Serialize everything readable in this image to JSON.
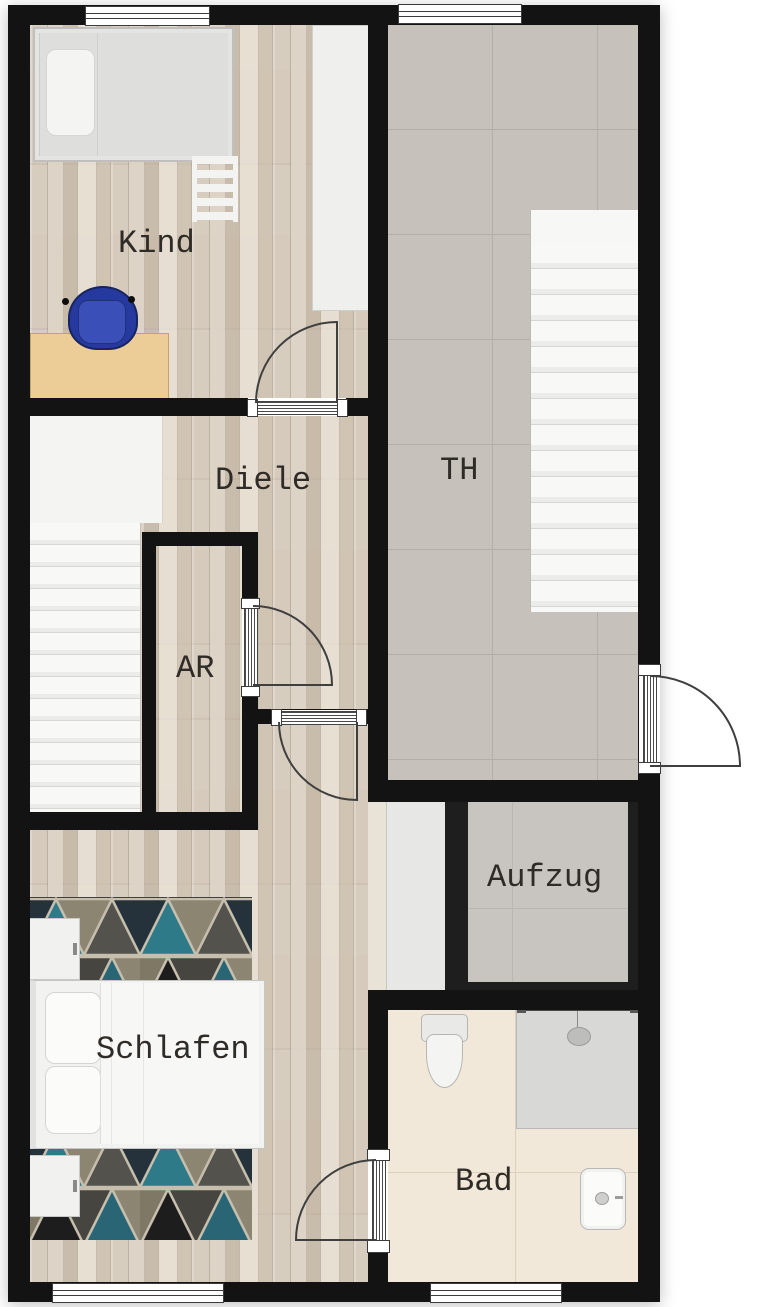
{
  "type": "floor-plan",
  "rooms": [
    {
      "id": "kind",
      "label": "Kind"
    },
    {
      "id": "diele",
      "label": "Diele"
    },
    {
      "id": "ar",
      "label": "AR"
    },
    {
      "id": "th",
      "label": "TH"
    },
    {
      "id": "aufzug",
      "label": "Aufzug"
    },
    {
      "id": "schlafen",
      "label": "Schlafen"
    },
    {
      "id": "bad",
      "label": "Bad"
    }
  ],
  "fixtures": [
    "single-bed",
    "bunk-ladder",
    "wall-shelf",
    "desk",
    "desk-chair",
    "staircase-left",
    "staircase-th",
    "elevator-cab",
    "double-bed",
    "nightstand-top",
    "nightstand-bottom",
    "triangle-rug",
    "wardrobe",
    "shower",
    "toilet",
    "sink"
  ],
  "openings": {
    "windows": 4,
    "door_swings": 5
  },
  "colors": {
    "wall": "#131313",
    "wood_floor": "#d5cabc",
    "tile_floor": "#c6c2bb",
    "bath_floor": "#f1e8d9",
    "stair_white": "#f6f6f5",
    "carpet_teal": "#2e7a88",
    "carpet_dark": "#1c1c1c",
    "carpet_olive": "#8b8571",
    "carpet_gray": "#54524c",
    "chair_blue": "#26399f",
    "desk_wood": "#eccd97",
    "elevator_frame": "#1e1e1e",
    "elevator_cab": "#c8c5c1",
    "swing_line": "#3f3f3f",
    "label_text": "#2f2b27",
    "background": "#ffffff"
  }
}
